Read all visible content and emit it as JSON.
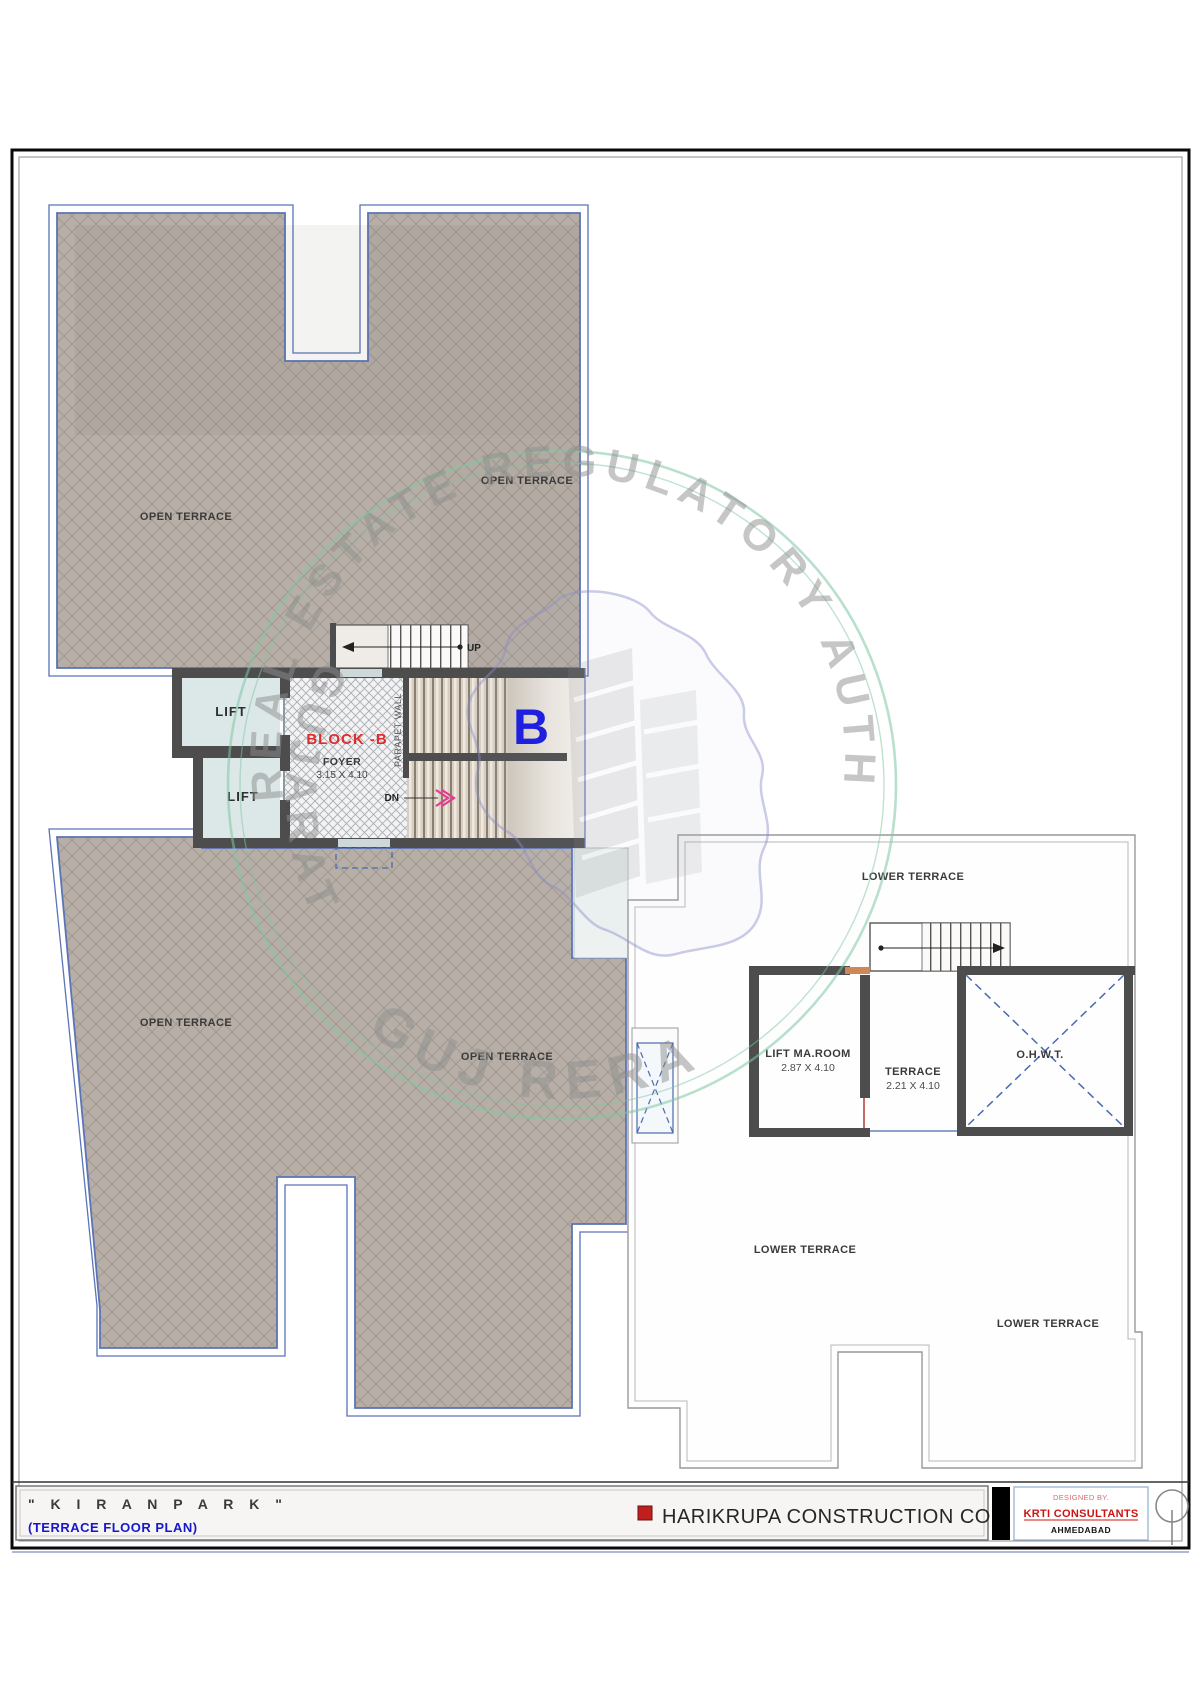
{
  "watermark": {
    "arc_top": "REAL ESTATE REGULATORY AUTHORITY",
    "side_left": "GUJARAT",
    "arc_bottom": "GUJ RERA"
  },
  "plan": {
    "upper_block": {
      "label_left": "OPEN TERRACE",
      "label_right": "OPEN TERRACE"
    },
    "lower_block": {
      "label_left": "OPEN TERRACE",
      "label_right": "OPEN TERRACE"
    },
    "core": {
      "lift1": "LIFT",
      "lift2": "LIFT",
      "block_name": "BLOCK -B",
      "foyer": "FOYER",
      "foyer_dim": "3.15 X 4.10",
      "parapet": "PARAPET WALL",
      "up": "UP",
      "dn": "DN",
      "block_letter": "B"
    },
    "lower_terrace": {
      "label_top": "LOWER TERRACE",
      "label_mid": "LOWER TERRACE",
      "label_right": "LOWER TERRACE",
      "lift_room": "LIFT MA.ROOM",
      "lift_room_dim": "2.87 X 4.10",
      "terrace": "TERRACE",
      "terrace_dim": "2.21 X 4.10",
      "ohwt": "O.H.W.T."
    }
  },
  "title_block": {
    "project": "\" K I R A N   P A R K \"",
    "plan_name": "(TERRACE FLOOR PLAN)",
    "company": "HARIKRUPA CONSTRUCTION CO.",
    "designed_by": "DESIGNED BY.",
    "consultant": "KRTI CONSULTANTS",
    "city": "AHMEDABAD"
  },
  "colors": {
    "outline_blue": "#5b74b8",
    "wall": "#4d4d4d",
    "hatch_fill": "#b7afa7",
    "accent_red": "#cc1414",
    "big_b_blue": "#1616df",
    "watermark_green": "#7fc6a2"
  }
}
